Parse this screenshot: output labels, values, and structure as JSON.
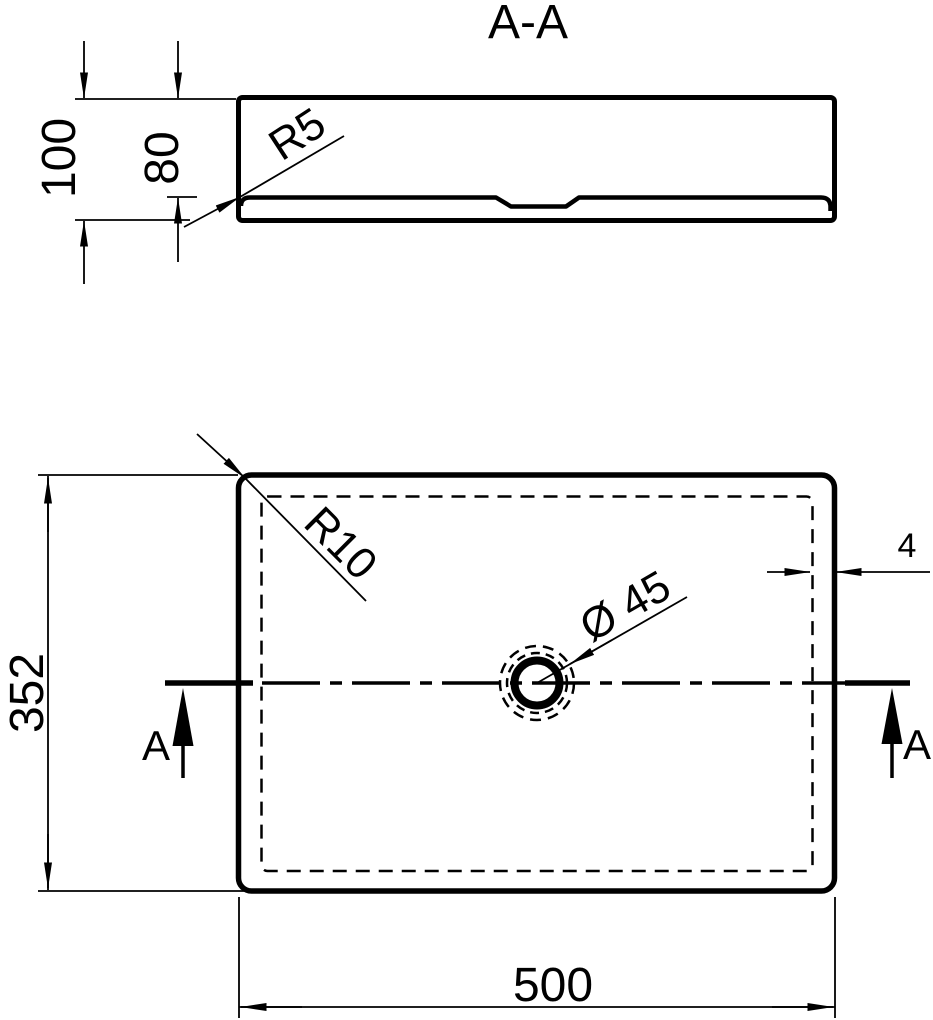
{
  "title": "A-A",
  "colors": {
    "ink": "#000000",
    "paper": "#ffffff"
  },
  "section_view": {
    "dim_total_height": "100",
    "dim_inner_depth": "80",
    "label_fillet_radius": "R5"
  },
  "plan_view": {
    "dim_length": "500",
    "dim_width": "352",
    "dim_wall_thickness": "4",
    "label_corner_radius": "R10",
    "label_drain_diameter": "Ø 45",
    "marker_left": "A",
    "marker_right": "A"
  }
}
